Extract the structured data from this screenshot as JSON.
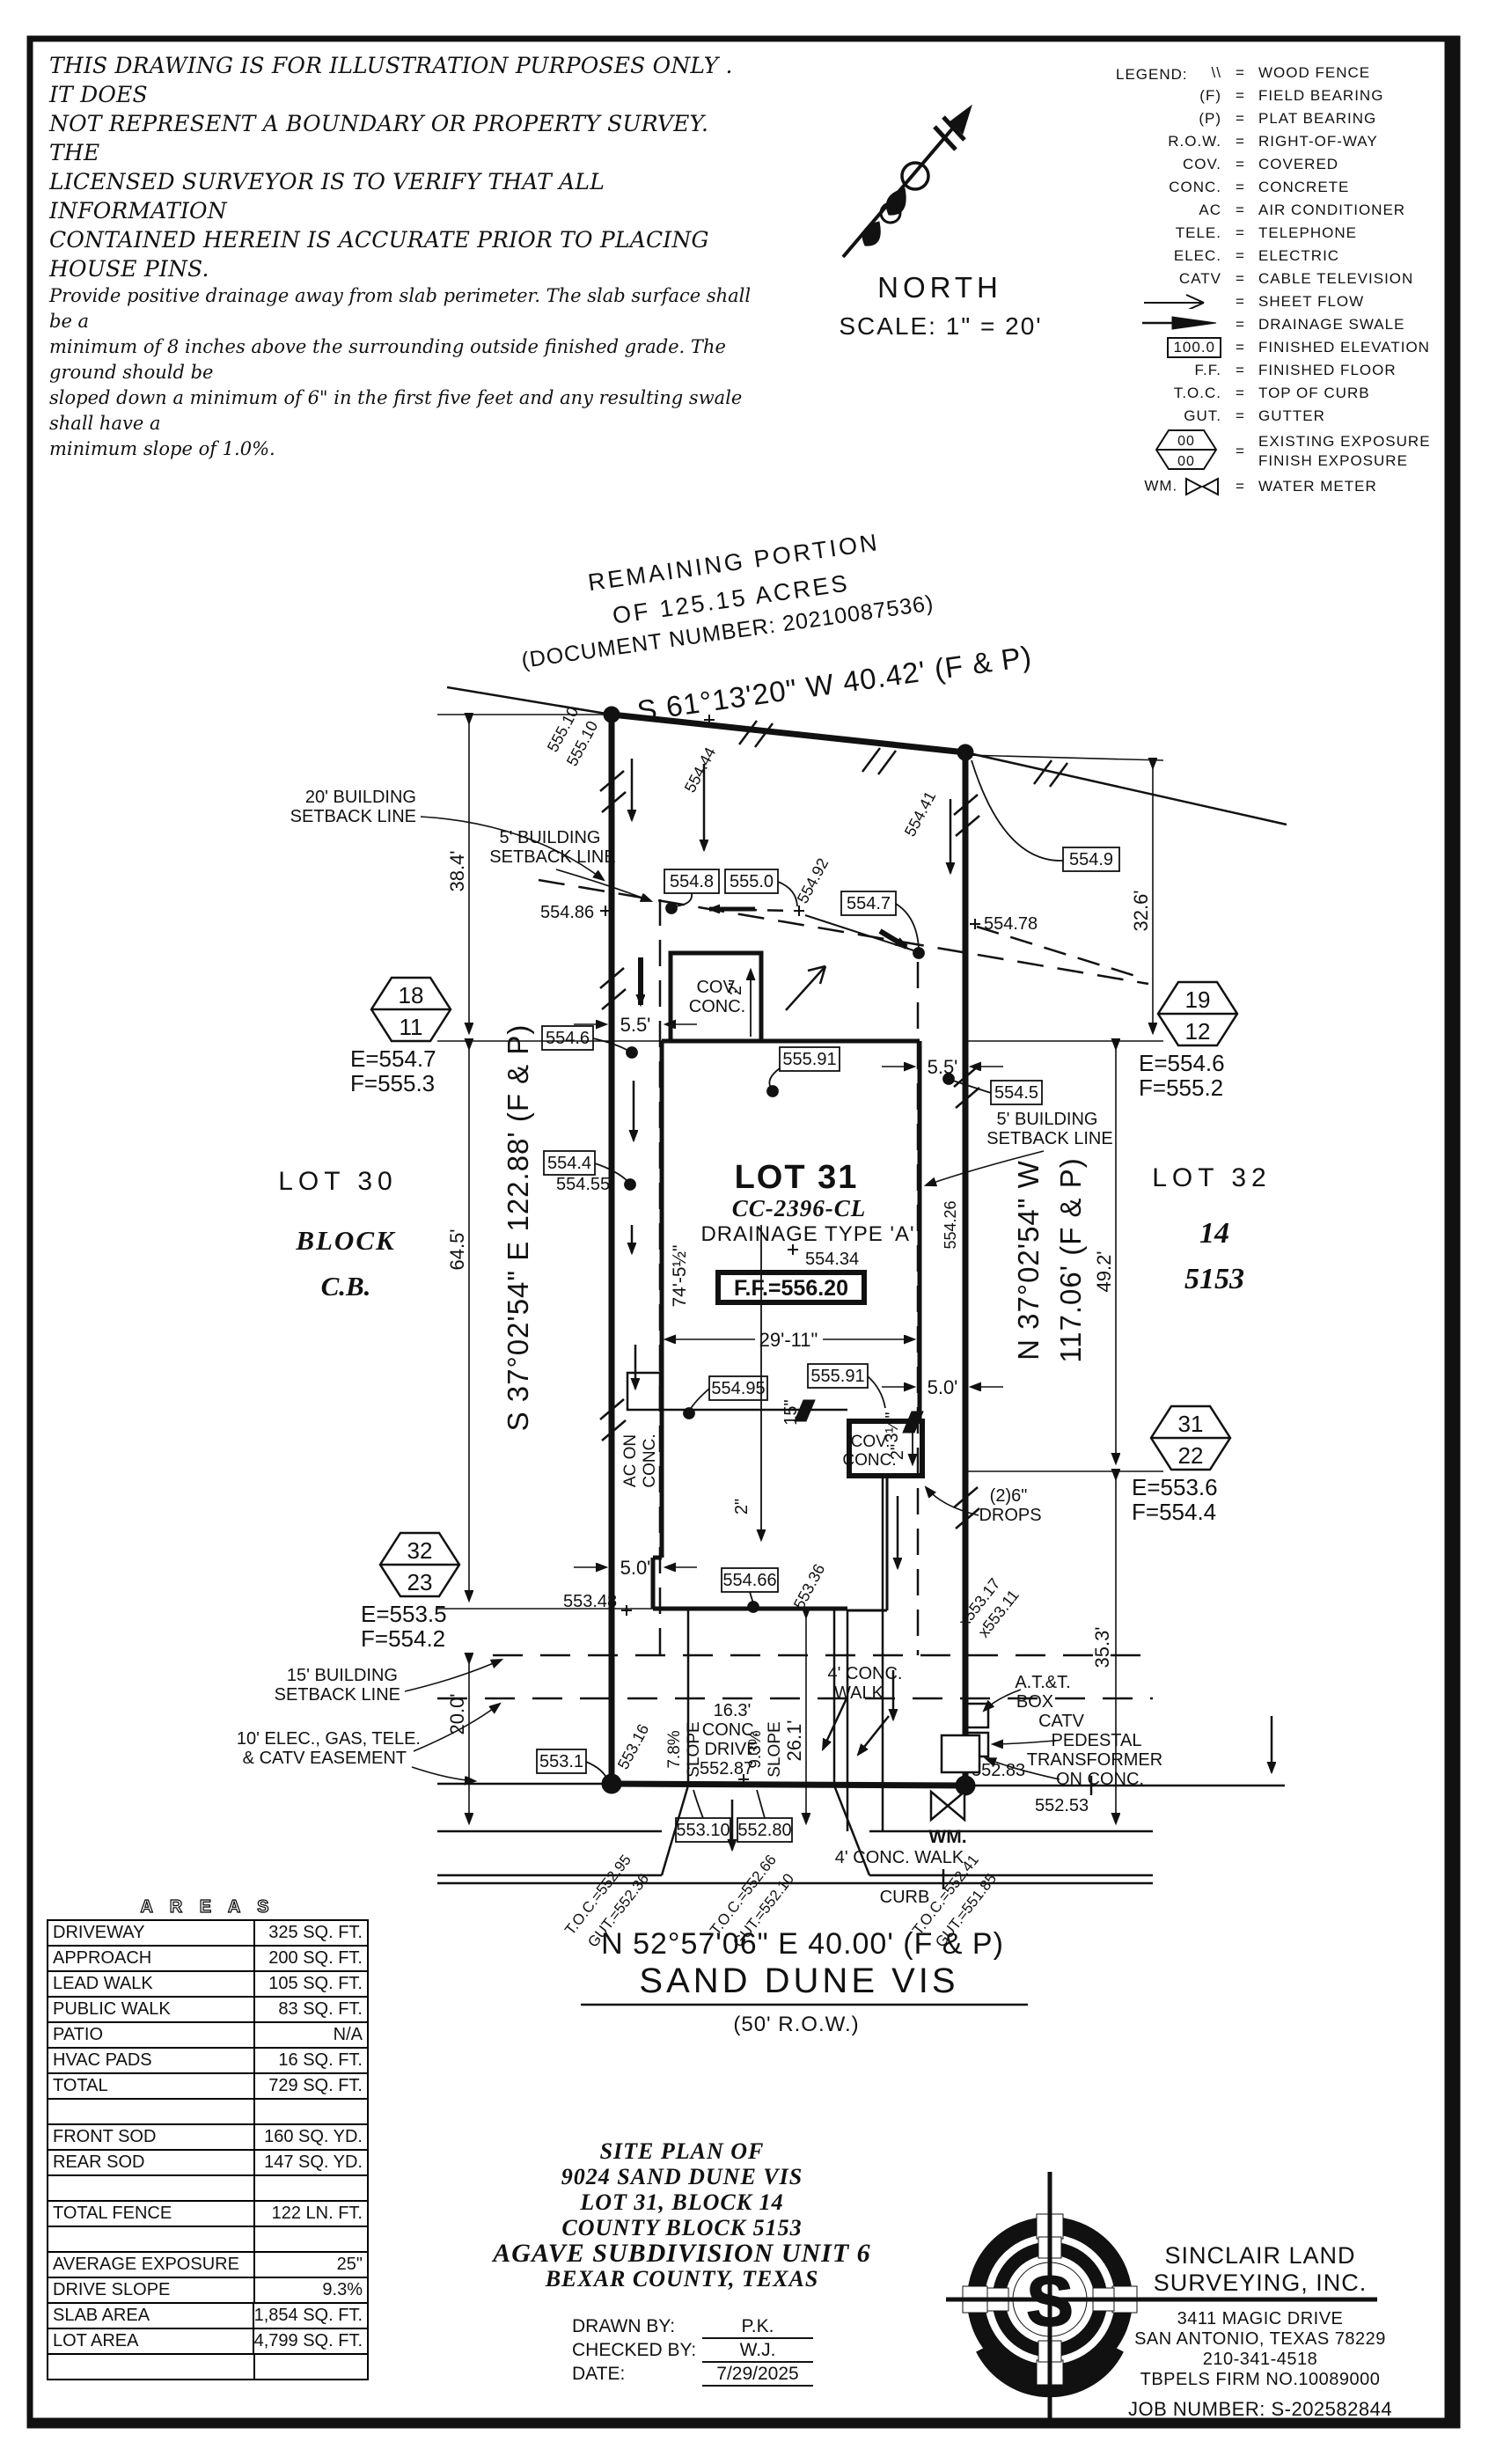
{
  "disclaimer": {
    "l1": "THIS DRAWING IS FOR ILLUSTRATION PURPOSES ONLY . IT DOES",
    "l2": "NOT REPRESENT A BOUNDARY OR PROPERTY SURVEY. THE",
    "l3": "LICENSED SURVEYOR IS TO VERIFY THAT ALL INFORMATION",
    "l4": "CONTAINED HEREIN IS ACCURATE PRIOR TO PLACING HOUSE PINS.",
    "p1": "Provide positive drainage away from slab perimeter. The slab surface shall be a",
    "p2": "minimum of 8 inches above the surrounding outside finished grade. The ground should be",
    "p3": "sloped down a minimum of 6\" in the first five feet and any resulting swale shall have a",
    "p4": "minimum slope of 1.0%."
  },
  "north": {
    "label": "NORTH",
    "scale": "SCALE:  1\" = 20'"
  },
  "legend": {
    "title": "LEGEND:",
    "hex_top": "00",
    "hex_bot": "00",
    "rows": [
      {
        "sym": "\\\\",
        "desc": "WOOD FENCE"
      },
      {
        "sym": "(F)",
        "desc": "FIELD BEARING"
      },
      {
        "sym": "(P)",
        "desc": "PLAT BEARING"
      },
      {
        "sym": "R.O.W.",
        "desc": "RIGHT-OF-WAY"
      },
      {
        "sym": "COV.",
        "desc": "COVERED"
      },
      {
        "sym": "CONC.",
        "desc": "CONCRETE"
      },
      {
        "sym": "AC",
        "desc": "AIR CONDITIONER"
      },
      {
        "sym": "TELE.",
        "desc": "TELEPHONE"
      },
      {
        "sym": "ELEC.",
        "desc": "ELECTRIC"
      },
      {
        "sym": "CATV",
        "desc": "CABLE TELEVISION"
      },
      {
        "sym": "",
        "desc": "SHEET FLOW"
      },
      {
        "sym": "",
        "desc": "DRAINAGE SWALE"
      },
      {
        "sym": "100.0",
        "desc": "FINISHED ELEVATION"
      },
      {
        "sym": "F.F.",
        "desc": "FINISHED FLOOR"
      },
      {
        "sym": "T.O.C.",
        "desc": "TOP OF CURB"
      },
      {
        "sym": "GUT.",
        "desc": "GUTTER"
      },
      {
        "sym": "",
        "desc1": "EXISTING EXPOSURE",
        "desc2": "FINISH EXPOSURE"
      },
      {
        "sym": "WM.",
        "desc": "WATER METER"
      }
    ]
  },
  "plan": {
    "rem1": "REMAINING PORTION",
    "rem2": "OF 125.15 ACRES",
    "rem3": "(DOCUMENT NUMBER:  20210087536)",
    "brg_top": "S 61°13'20\" W  40.42'  (F & P)",
    "brg_left": "S 37°02'54\" E  122.88'  (F & P)",
    "brg_r1": "N 37°02'54\" W",
    "brg_r2": "117.06'  (F & P)",
    "brg_bottom": "N 52°57'06\" E  40.00'  (F & P)",
    "street": "SAND DUNE VIS",
    "row50": "(50' R.O.W.)",
    "lot30": "LOT 30",
    "lot30b": "BLOCK",
    "lot30c": "C.B.",
    "lot31": "LOT 31",
    "cc": "CC-2396-CL",
    "drn": "DRAINAGE TYPE 'A'",
    "ff": "F.F.=556.20",
    "s55434": "554.34",
    "lot32": "LOT 32",
    "lot32b": "14",
    "lot32c": "5153",
    "sb20a": "20' BUILDING",
    "sb20b": "SETBACK LINE",
    "sb5a": "5' BUILDING",
    "sb5b": "SETBACK LINE",
    "sb15a": "15' BUILDING",
    "sb15b": "SETBACK LINE",
    "easea": "10' ELEC., GAS, TELE.",
    "easeb": "& CATV EASEMENT",
    "d38": "38.4'",
    "d64": "64.5'",
    "d20": "20.0'",
    "d32": "32.6'",
    "d49": "49.2'",
    "d35": "35.3'",
    "d29": "29'-11\"",
    "d74": "74'-5½\"",
    "d26": "26.1'",
    "d55": "5.5'",
    "d50": "5.0'",
    "d15": "15\"",
    "d35i": "3½\"",
    "d2": "2\"",
    "b5549": "554.9",
    "b5548": "554.8",
    "b5550": "555.0",
    "b5547": "554.7",
    "b5545": "554.5",
    "b5546": "554.6",
    "b5544": "554.4",
    "b55591": "555.91",
    "b55495": "554.95",
    "b55466": "554.66",
    "b5531": "553.1",
    "b55310": "553.10",
    "b55280": "552.80",
    "s55510": "555.10",
    "s55444": "554.44",
    "s55441": "554.41",
    "s55486": "554.86",
    "s55492": "554.92",
    "s55478": "554.78",
    "s55455": "554.55",
    "s55426": "554.26",
    "s55348": "553.48",
    "s55336": "553.36",
    "s55317": "x553.17",
    "s55311": "x553.11",
    "s55316": "553.16",
    "s55287": "552.87",
    "s55283": "552.83",
    "s55253": "552.53",
    "cov1": "COV.",
    "cov2": "CONC.",
    "ac1": "AC ON",
    "ac2": "CONC.",
    "drops1": "(2)6\"",
    "drops2": "DROPS",
    "att1": "A.T.&T.",
    "att2": "BOX",
    "catv": "CATV",
    "ped": "PEDESTAL",
    "tx": "TRANSFORMER",
    "onc": "ON CONC.",
    "wk1": "4' CONC.",
    "wk2": "WALK",
    "wk": "4' CONC. WALK",
    "curb": "CURB",
    "dv1": "16.3'",
    "dv2": "CONC.",
    "dv3": "DRIVE",
    "s78": "7.8%",
    "s93": "9.3%",
    "slp": "SLOPE",
    "wm": "WM.",
    "t1a": "T.O.C.=552.95",
    "t1b": "GUT.=552.36",
    "t2a": "T.O.C.=552.66",
    "t2b": "GUT.=552.10",
    "t3a": "T.O.C.=552.41",
    "t3b": "GUT.=551.85",
    "hex18t": "18",
    "hex18b": "11",
    "hex18e": "E=554.7",
    "hex18f": "F=555.3",
    "hex19t": "19",
    "hex19b": "12",
    "hex19e": "E=554.6",
    "hex19f": "F=555.2",
    "hex31t": "31",
    "hex31b": "22",
    "hex31e": "E=553.6",
    "hex31f": "F=554.4",
    "hex32t": "32",
    "hex32b": "23",
    "hex32e": "E=553.5",
    "hex32f": "F=554.2"
  },
  "areas": {
    "title": "A R E A S",
    "rows": [
      {
        "label": "DRIVEWAY",
        "value": "325 SQ. FT."
      },
      {
        "label": "APPROACH",
        "value": "200 SQ. FT."
      },
      {
        "label": "LEAD WALK",
        "value": "105 SQ. FT."
      },
      {
        "label": "PUBLIC WALK",
        "value": "83 SQ. FT."
      },
      {
        "label": "PATIO",
        "value": "N/A"
      },
      {
        "label": "HVAC PADS",
        "value": "16 SQ. FT."
      },
      {
        "label": "TOTAL",
        "value": "729 SQ. FT."
      },
      {
        "label": "",
        "value": ""
      },
      {
        "label": "FRONT SOD",
        "value": "160 SQ. YD."
      },
      {
        "label": "REAR SOD",
        "value": "147 SQ. YD."
      },
      {
        "label": "",
        "value": ""
      },
      {
        "label": "TOTAL FENCE",
        "value": "122 LN. FT."
      },
      {
        "label": "",
        "value": ""
      },
      {
        "label": "AVERAGE EXPOSURE",
        "value": "25\""
      },
      {
        "label": "DRIVE SLOPE",
        "value": "9.3%"
      },
      {
        "label": "SLAB AREA",
        "value": "1,854 SQ. FT."
      },
      {
        "label": "LOT AREA",
        "value": "4,799 SQ. FT."
      },
      {
        "label": "",
        "value": ""
      }
    ]
  },
  "titleblock": {
    "l1": "SITE PLAN OF",
    "l2": "9024 SAND DUNE VIS",
    "l3": "LOT 31, BLOCK 14",
    "l4": "COUNTY BLOCK 5153",
    "l5": "AGAVE SUBDIVISION UNIT 6",
    "l6": "BEXAR COUNTY, TEXAS",
    "drawn_label": "DRAWN BY:",
    "drawn": "P.K.",
    "checked_label": "CHECKED BY:",
    "checked": "W.J.",
    "date_label": "DATE:",
    "date": "7/29/2025"
  },
  "company": {
    "name1": "SINCLAIR LAND",
    "name2": "SURVEYING, INC.",
    "addr1": "3411 MAGIC DRIVE",
    "addr2": "SAN ANTONIO, TEXAS 78229",
    "phone": "210-341-4518",
    "firm": "TBPELS FIRM NO.10089000",
    "job": "JOB NUMBER:  S-202582844",
    "logo_letter": "S"
  },
  "colors": {
    "accent": "#C05A2C",
    "ink": "#111111"
  }
}
